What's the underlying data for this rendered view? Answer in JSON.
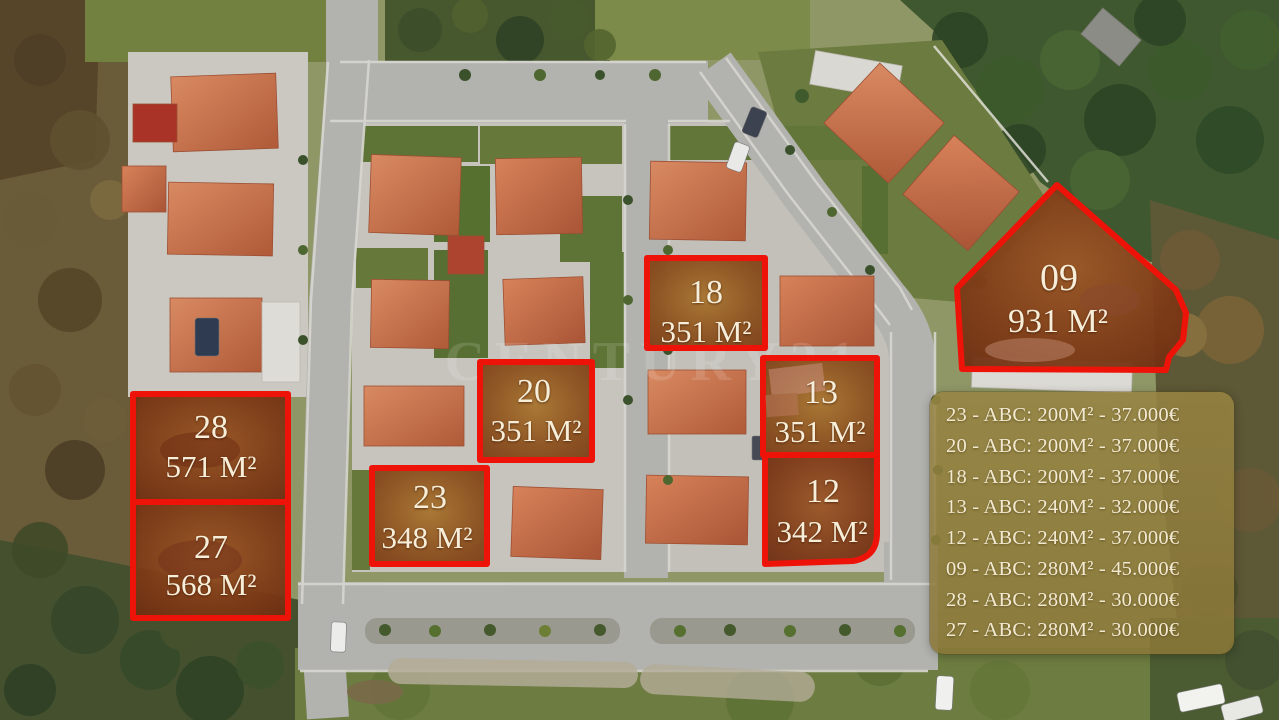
{
  "watermark": "CENTURY21",
  "colors": {
    "plot_outline_red": "#ee1309",
    "plot_fill_gold": "#8a4e1c",
    "plot_fill_rust": "#7e3a16",
    "panel_background": "#94813e",
    "panel_text": "#f2e9d1",
    "label_text": "#f6eed8",
    "roof_terracotta": "#c97350",
    "road_gray": "#b2b2ae"
  },
  "plots": [
    {
      "id": "28",
      "area": "571 M²"
    },
    {
      "id": "27",
      "area": "568 M²"
    },
    {
      "id": "23",
      "area": "348 M²"
    },
    {
      "id": "20",
      "area": "351 M²"
    },
    {
      "id": "18",
      "area": "351 M²"
    },
    {
      "id": "13",
      "area": "351 M²"
    },
    {
      "id": "12",
      "area": "342 M²"
    },
    {
      "id": "09",
      "area": "931 M²"
    }
  ],
  "price_list": {
    "rows": [
      "23 - ABC: 200M² - 37.000€",
      "20 - ABC: 200M² - 37.000€",
      "18 - ABC: 200M² - 37.000€",
      "13 - ABC: 240M² - 32.000€",
      "12 - ABC: 240M² - 37.000€",
      "09 - ABC: 280M² - 45.000€",
      "28 - ABC: 280M² - 30.000€",
      "27 - ABC: 280M² - 30.000€"
    ]
  }
}
